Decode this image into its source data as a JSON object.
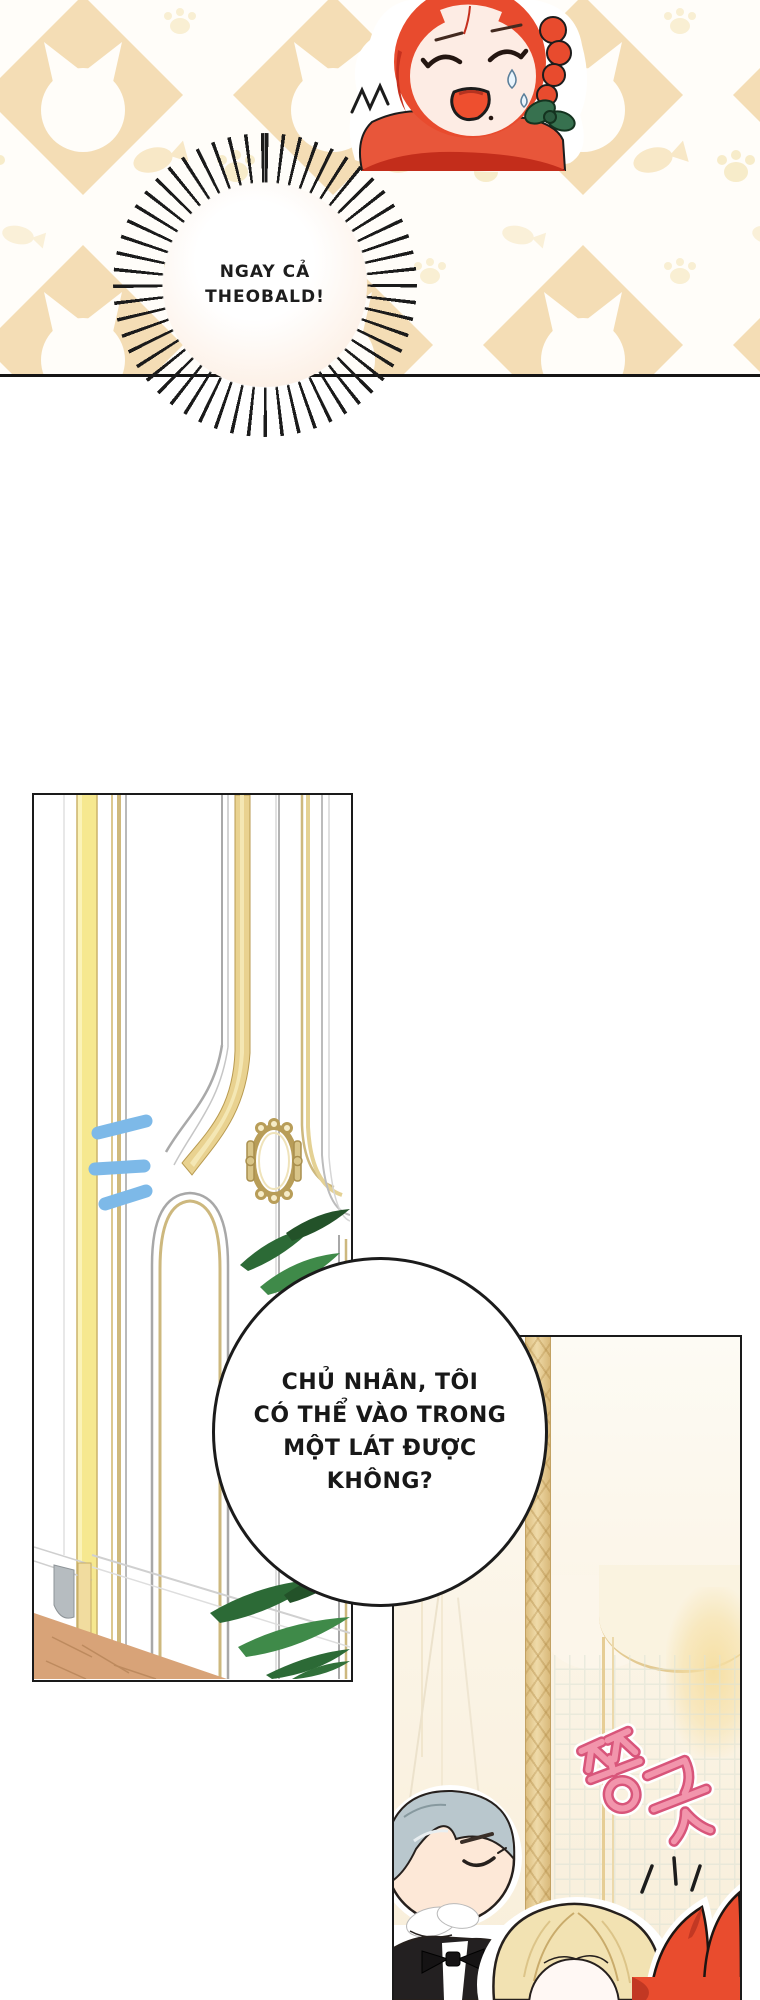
{
  "comic": {
    "burst_bubble": {
      "lines": [
        "NGAY CẢ",
        "THEOBALD!"
      ]
    },
    "speech_bubble": {
      "lines": [
        "CHỦ NHÂN, TÔI",
        "CÓ THỂ VÀO TRONG",
        "MỘT LÁT ĐƯỢC",
        "KHÔNG?"
      ]
    },
    "sfx": {
      "korean": "쫑긋"
    }
  },
  "colors": {
    "panel_border": "#1a1a1a",
    "pattern_diamond": "#f4ddb5",
    "pattern_fish": "#f8e8c7",
    "pattern_paw": "#f7ecca",
    "girl_hair_red": "#e84b2e",
    "girl_skin": "#fdece4",
    "girl_bow_green": "#37714f",
    "knock_blue": "#7db9e8",
    "gold_trim": "#cdb87e",
    "door_yellow": "#f6e88f",
    "leaf_green": "#2c6a36",
    "floor_wood": "#d8a378",
    "butler_hair_gray": "#b9c7cd",
    "butler_suit_black": "#232021",
    "child_hair_blonde": "#f2e2b2",
    "red_bow": "#e94c2e",
    "sfx_pink": "#e87095"
  }
}
